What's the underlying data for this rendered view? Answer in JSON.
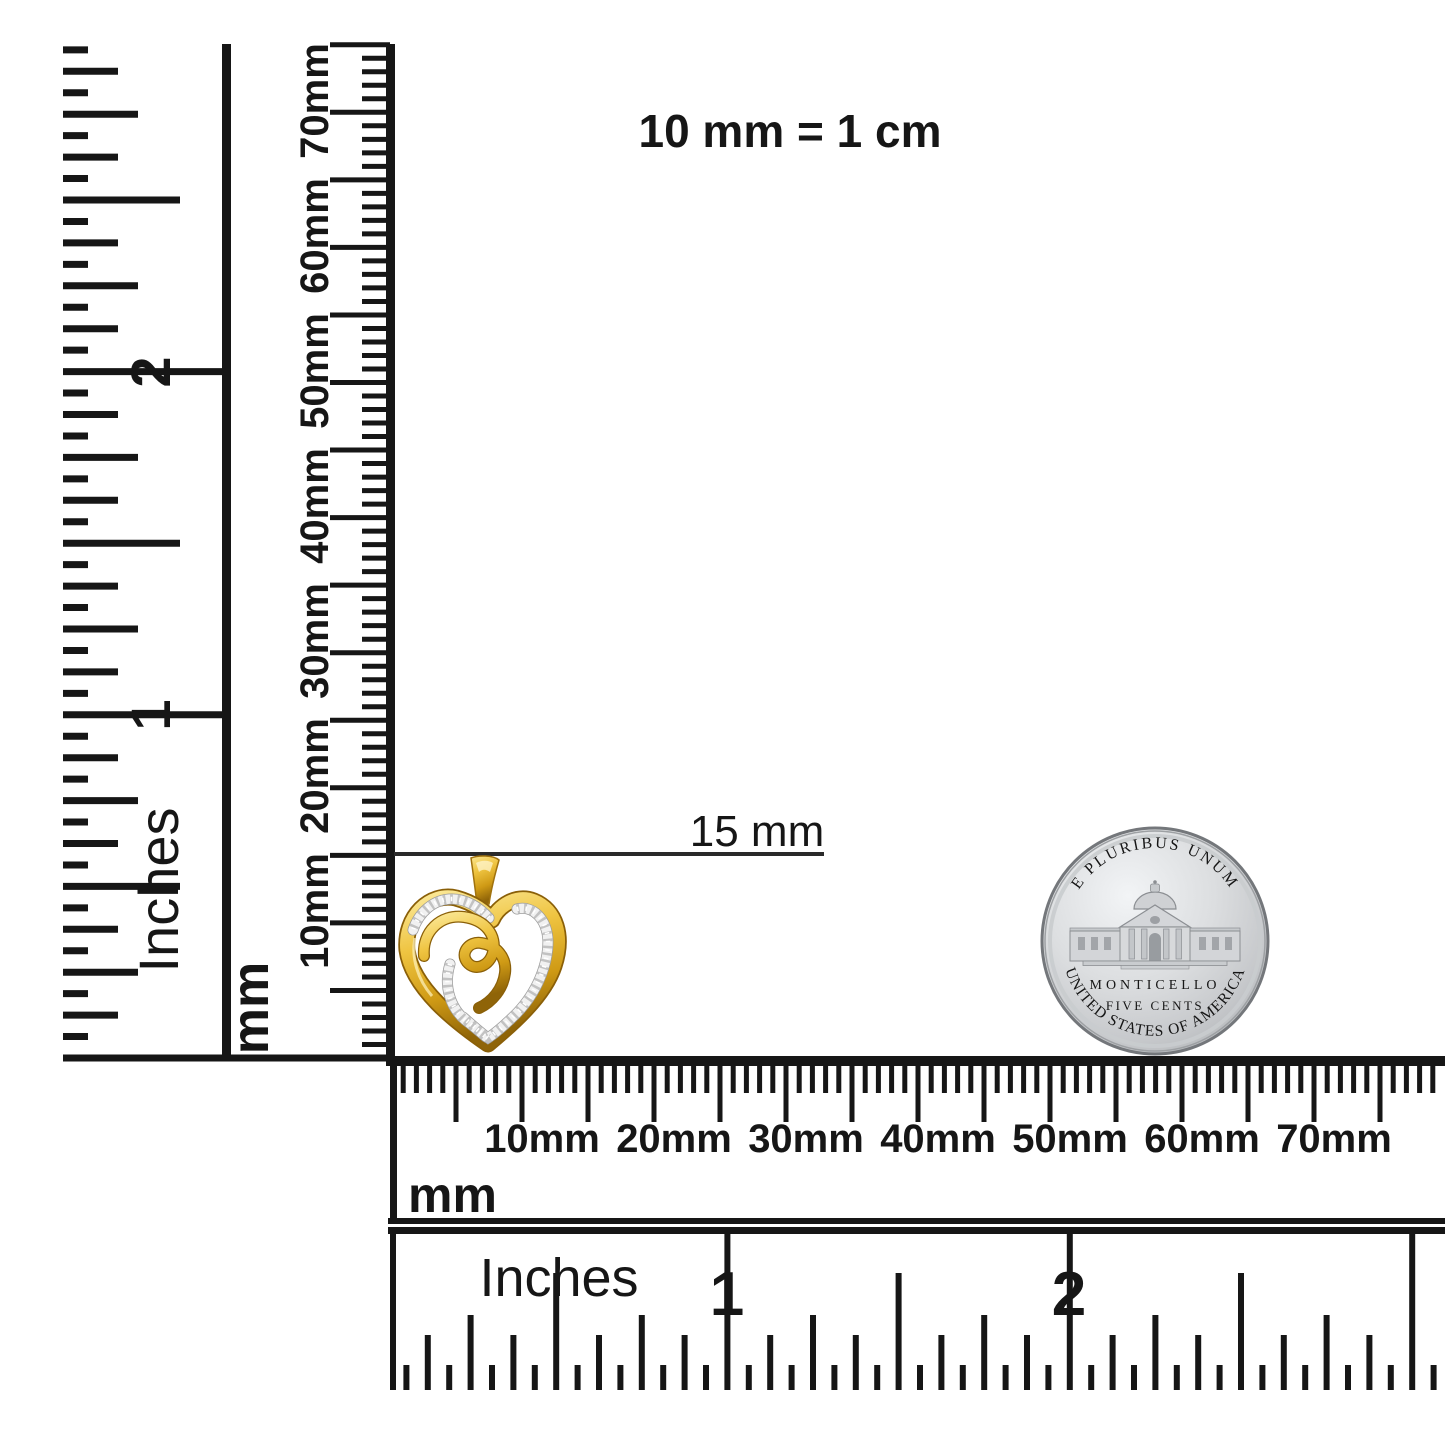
{
  "scale_note": "10 mm = 1 cm",
  "pendant": {
    "size_label": "15 mm",
    "object_name": "gold-heart-diamond-pendant"
  },
  "coin": {
    "object_name": "us-nickel-reverse",
    "top_legend": "E PLURIBUS UNUM",
    "building_label": "MONTICELLO",
    "denomination": "FIVE CENTS",
    "bottom_legend": "UNITED STATES OF AMERICA"
  },
  "rulers": {
    "left_inches": {
      "unit": "Inches",
      "n1": "1",
      "n2": "2"
    },
    "left_mm": {
      "unit": "mm",
      "labels": [
        "10mm",
        "20mm",
        "30mm",
        "40mm",
        "50mm",
        "60mm",
        "70mm"
      ]
    },
    "bottom_mm": {
      "unit": "mm",
      "labels": [
        "10mm",
        "20mm",
        "30mm",
        "40mm",
        "50mm",
        "60mm",
        "70mm"
      ]
    },
    "bottom_inches": {
      "unit": "Inches",
      "n1": "1",
      "n2": "2"
    }
  }
}
